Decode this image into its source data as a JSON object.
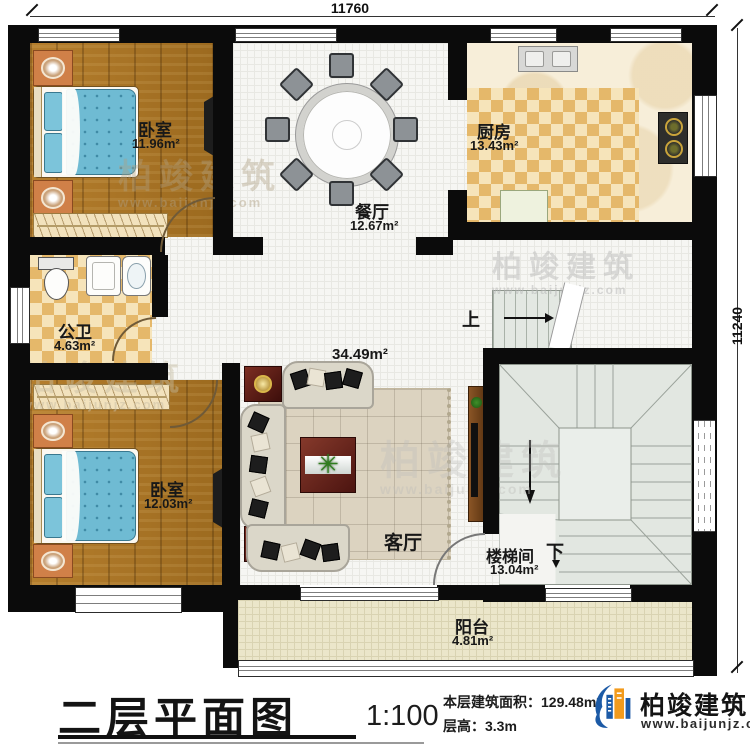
{
  "dimensions": {
    "top": "11760",
    "right": "11240"
  },
  "rooms": [
    {
      "name": "卧室",
      "area": "11.96m²"
    },
    {
      "name": "餐厅",
      "area": "12.67m²"
    },
    {
      "name": "厨房",
      "area": "13.43m²"
    },
    {
      "name": "公卫",
      "area": "4.63m²"
    },
    {
      "name": "卧室",
      "area": "12.03m²"
    },
    {
      "name": "客厅",
      "area": "34.49m²"
    },
    {
      "name": "楼梯间",
      "area": "13.04m²"
    },
    {
      "name": "阳台",
      "area": "4.81m²"
    }
  ],
  "stairs": {
    "up": "上",
    "down": "下"
  },
  "titleblock": {
    "title": "二层平面图",
    "scale": "1:100",
    "area_label": "本层建筑面积：",
    "area_value": "129.48m²",
    "height_label": "层高：",
    "height_value": "3.3m"
  },
  "brand": {
    "name": "柏竣建筑",
    "url": "www.baijunjz.com"
  },
  "watermark": {
    "name": "柏竣建筑",
    "url": "www.baijunjz.com"
  },
  "colors": {
    "brand_blue": "#1c5aa6",
    "brand_orange": "#f29b1d",
    "wall_black": "#0b0b0b"
  }
}
